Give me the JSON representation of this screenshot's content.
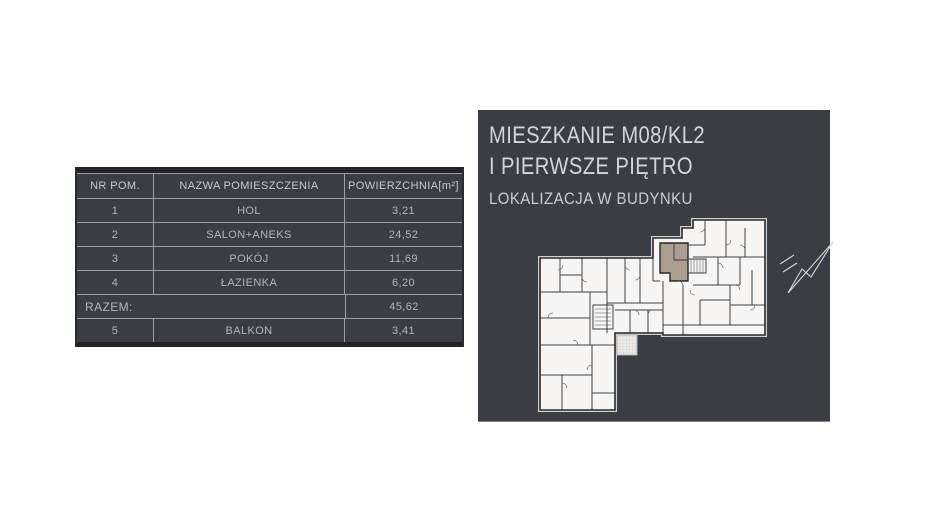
{
  "table": {
    "columns": [
      "NR POM.",
      "NAZWA POMIESZCZENIA",
      "POWIERZCHNIA[m²]"
    ],
    "rows": [
      {
        "nr": "1",
        "name": "HOL",
        "area": "3,21"
      },
      {
        "nr": "2",
        "name": "SALON+ANEKS",
        "area": "24,52"
      },
      {
        "nr": "3",
        "name": "POKÓJ",
        "area": "11,69"
      },
      {
        "nr": "4",
        "name": "ŁAZIENKA",
        "area": "6,20"
      }
    ],
    "total": {
      "label": "RAZEM:",
      "value": "45,62"
    },
    "extra_rows": [
      {
        "nr": "5",
        "name": "BALKON",
        "area": "3,41"
      }
    ]
  },
  "panel": {
    "title_line1": "MIESZKANIE M08/KL2",
    "title_line2": "I PIERWSZE PIĘTRO",
    "subtitle": "LOKALIZACJA W BUDYNKU"
  },
  "icons": {
    "north_arrow": "north-arrow-icon"
  },
  "colors": {
    "panel_bg": "#3a3d42",
    "table_bg": "#3a3d42",
    "table_strip": "#212326",
    "table_border": "#9c9fa2",
    "table_text": "#b3b5b7",
    "table_header_text": "#c8cacc",
    "panel_text": "#d3d5d7",
    "panel_subtext": "#c9cbcd",
    "highlight_unit": "#ab9e90",
    "plan_fill": "#f6f5f3",
    "plan_wall": "#26282b"
  }
}
